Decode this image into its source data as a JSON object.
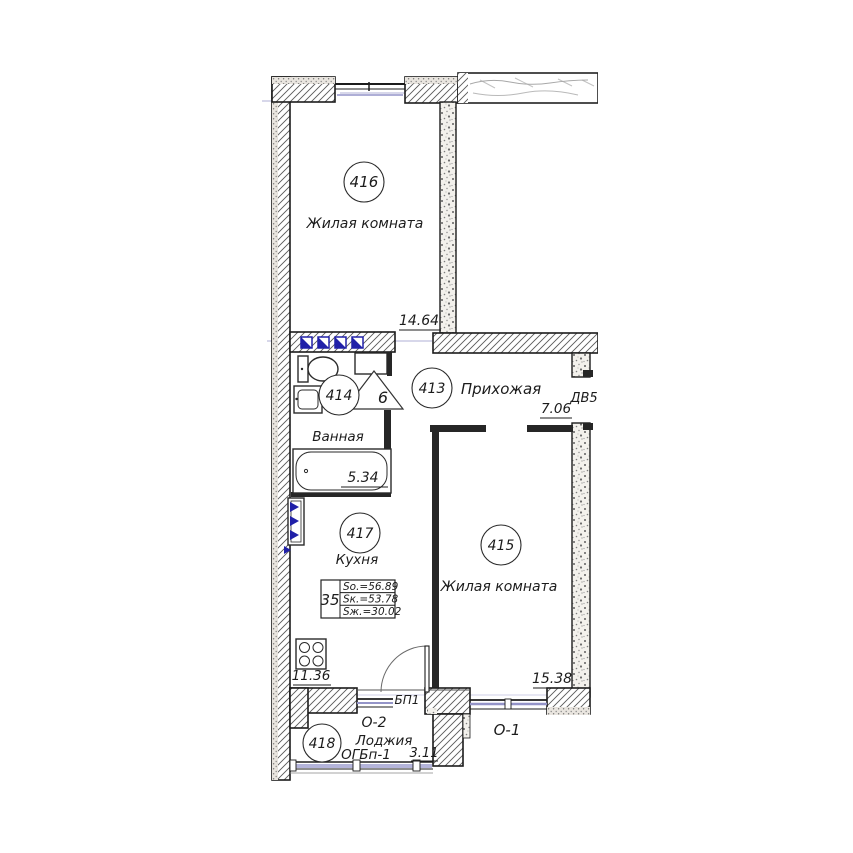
{
  "plan": {
    "rooms": {
      "r416": {
        "number": "416",
        "name": "Жилая комната",
        "area": "14.64"
      },
      "r413": {
        "number": "413",
        "name": "Прихожая",
        "area": "7.06"
      },
      "r414": {
        "number": "414",
        "name": "Ванная",
        "area": "5.34"
      },
      "r417": {
        "number": "417",
        "name": "Кухня",
        "area": "11.36"
      },
      "r415": {
        "number": "415",
        "name": "Жилая комната",
        "area": "15.38"
      },
      "r418": {
        "number": "418",
        "name": "Лоджия",
        "area": "3.11",
        "glazing_type": "ОГБп-1"
      }
    },
    "openings": {
      "entry_door": "ДВ5",
      "balcony_door": "БП1",
      "window_1": "О-1",
      "window_2": "О-2",
      "vent_shaft": "6"
    },
    "apartment_info": {
      "number": "35",
      "areas": [
        {
          "label": "Sо.=56.89"
        },
        {
          "label": "Sк.=53.78"
        },
        {
          "label": "Sж.=30.02"
        }
      ]
    },
    "colors": {
      "wall_line": "#1c1c1c",
      "glass_blue": "#9494c8",
      "marker_blue": "#2020a8",
      "stipple_wall": "#f3f1ec"
    }
  }
}
